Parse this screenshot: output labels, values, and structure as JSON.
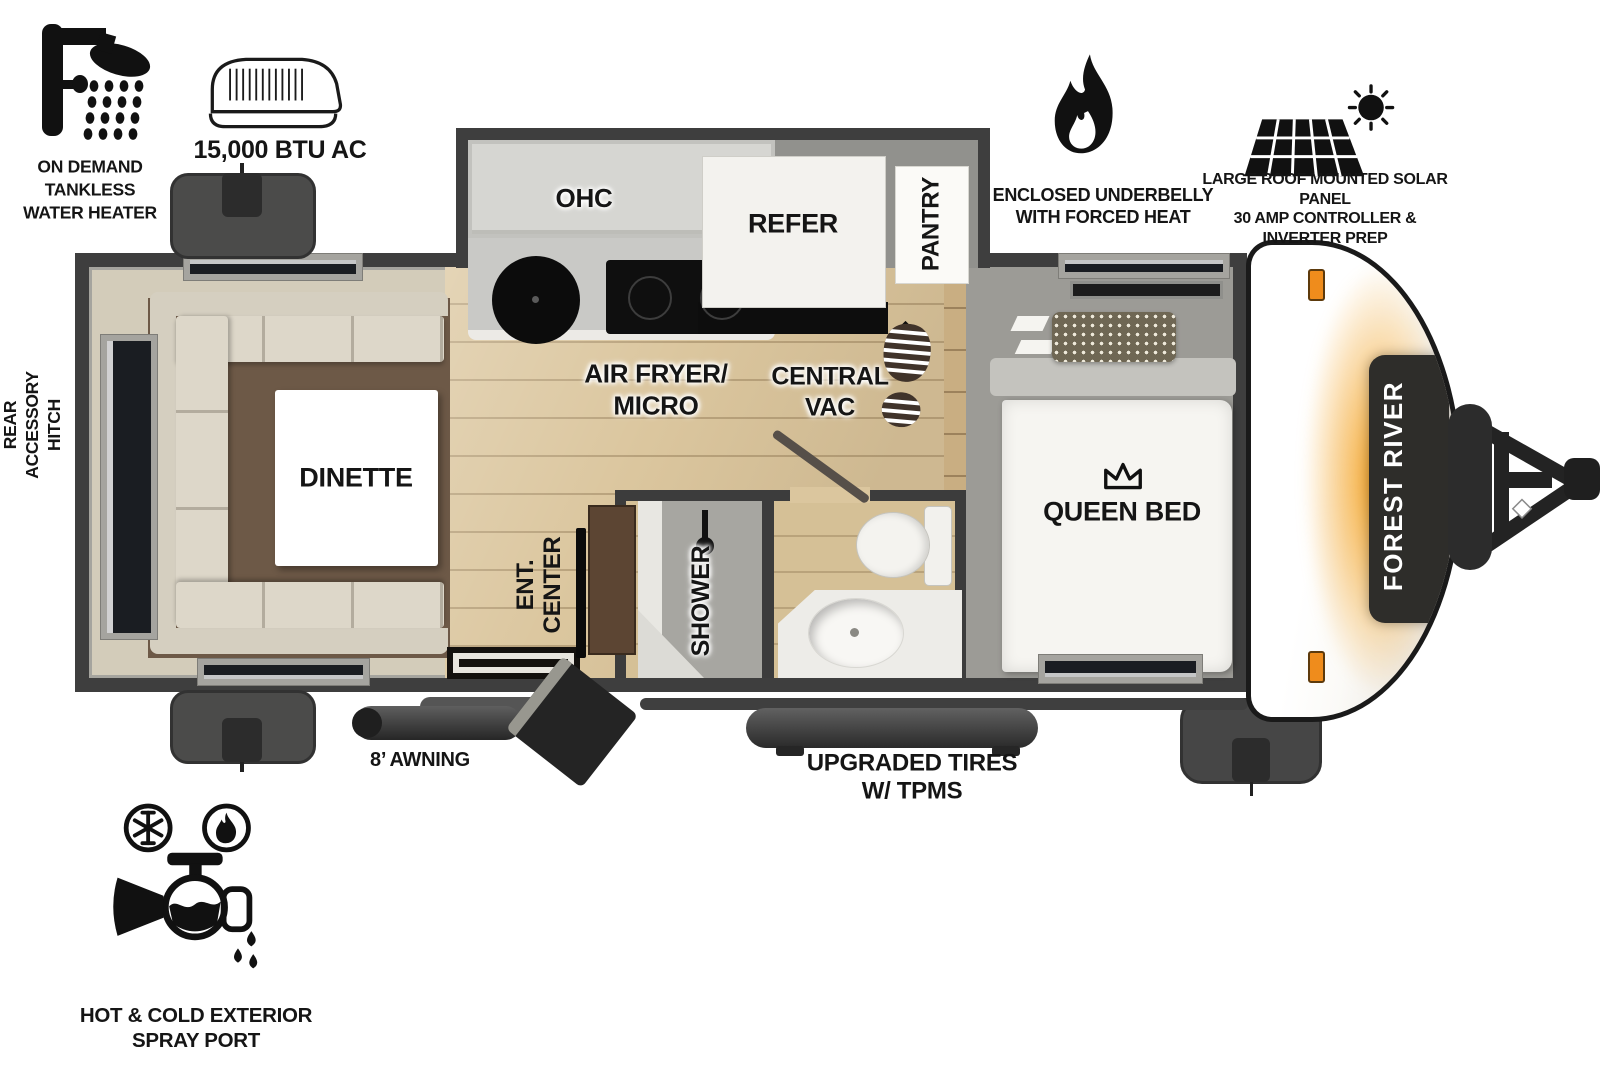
{
  "features": {
    "water_heater": {
      "label": "ON DEMAND\nTANKLESS\nWATER HEATER",
      "icon": "shower-icon"
    },
    "ac": {
      "label": "15,000 BTU AC",
      "icon": "rooftop-ac-icon"
    },
    "underbelly": {
      "label": "ENCLOSED UNDERBELLY\nWITH FORCED HEAT",
      "icon": "flame-icon"
    },
    "solar": {
      "label": "LARGE ROOF MOUNTED SOLAR PANEL\n30 AMP CONTROLLER & INVERTER PREP",
      "icon": "solar-panel-icon"
    },
    "spray_port": {
      "label": "HOT & COLD EXTERIOR\nSPRAY PORT",
      "icon": "spray-port-icon"
    },
    "rear_hitch": {
      "label": "REAR\nACCESSORY\nHITCH"
    },
    "awning": {
      "label": "8’ AWNING"
    },
    "tires": {
      "label": "UPGRADED TIRES\nW/ TPMS"
    }
  },
  "floorplan": {
    "brand": "FOREST RIVER",
    "rooms": {
      "dinette": "DINETTE",
      "ohc": "OHC",
      "refer": "REFER",
      "pantry": "PANTRY",
      "air_fryer_micro": "AIR FRYER/\nMICRO",
      "central_vac": "CENTRAL\nVAC",
      "ent_center": "ENT.\nCENTER",
      "shower": "SHOWER",
      "queen_bed": "QUEEN BED"
    },
    "icons": {
      "queen_bed": "crown-icon",
      "central_vac": "boot-print-icon",
      "shower": "shower-head-icon"
    }
  },
  "colors": {
    "wall": "#3e3e3e",
    "interior_floor": "#d3ccba",
    "wood_floor": "#dbc69e",
    "bedroom_floor": "#9c9b96",
    "rug": "#6d5947",
    "sofa": "#d9d3c5",
    "cabinet_brown": "#5c4533",
    "accent_orange": "#f08c1c",
    "cap_panel": "#2e2d2a",
    "icon_black": "#111111"
  }
}
